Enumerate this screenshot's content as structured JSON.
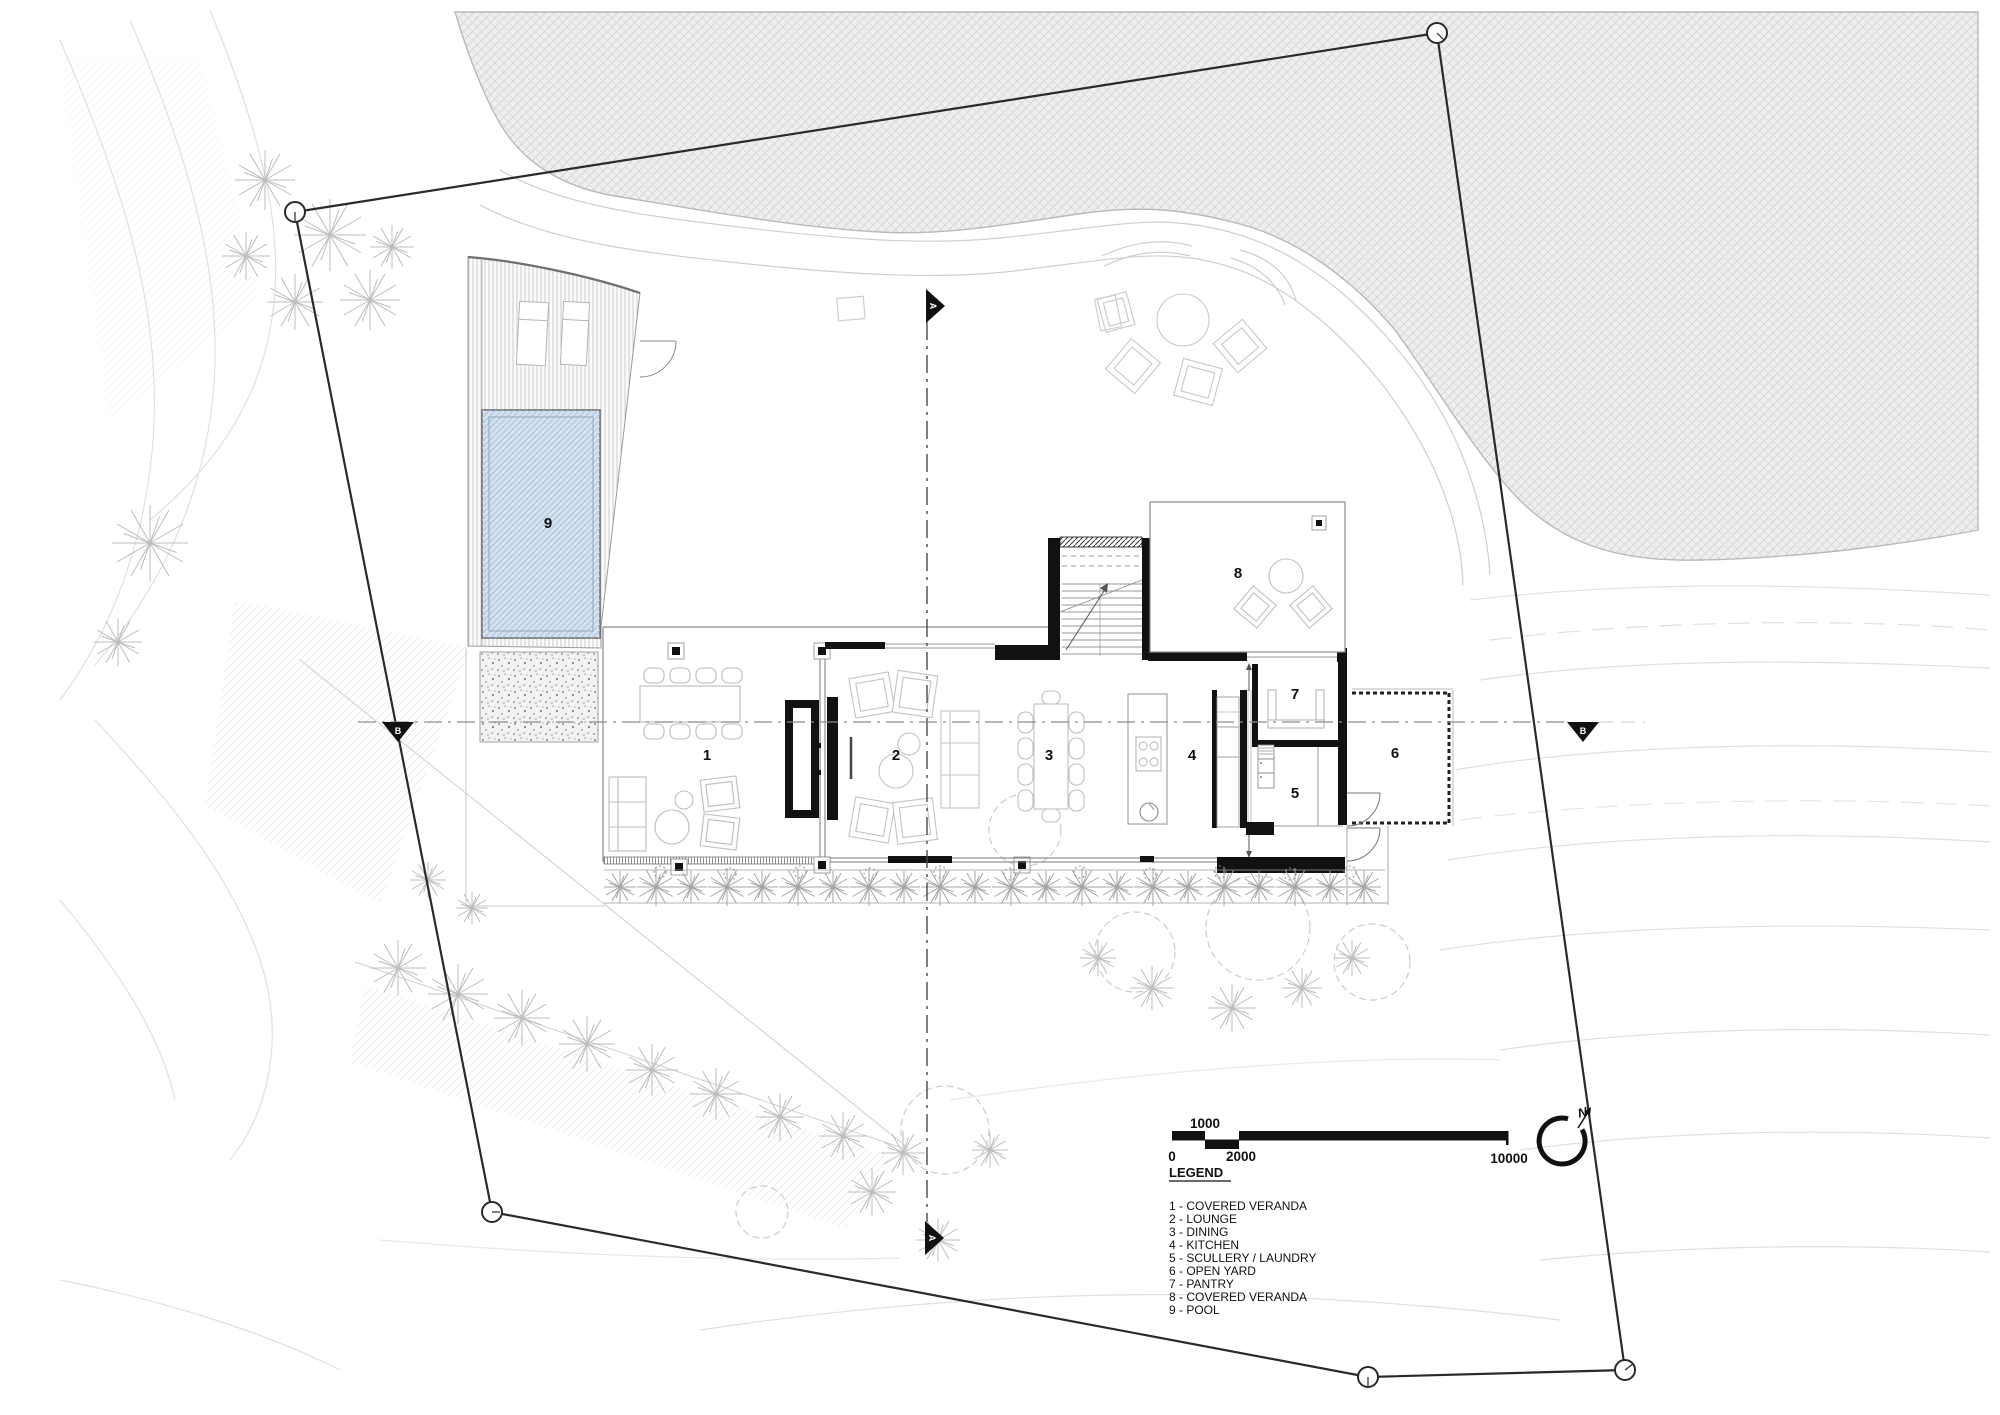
{
  "plan": {
    "room_labels": [
      "1",
      "2",
      "3",
      "4",
      "5",
      "6",
      "7",
      "8",
      "9"
    ]
  },
  "legend": {
    "heading": "LEGEND",
    "items": [
      "1 - COVERED VERANDA",
      "2 - LOUNGE",
      "3 - DINING",
      "4 - KITCHEN",
      "5 - SCULLERY / LAUNDRY",
      "6 - OPEN YARD",
      "7 - PANTRY",
      "8 - COVERED VERANDA",
      "9 - POOL"
    ]
  },
  "scale_bar": {
    "upper_label": "1000",
    "zero_label": "0",
    "mid_label": "2000",
    "end_label": "10000"
  },
  "north_arrow": {
    "label": "N"
  },
  "section_markers": {
    "vertical_label": "A",
    "horizontal_label": "B"
  },
  "colors": {
    "wall": "#111111",
    "pool_fill": "#d4e1f0",
    "pool_hatch": "#a8bcd4",
    "vegetation_hatch": "#d2d2d2",
    "contour": "#e0e0e0"
  }
}
